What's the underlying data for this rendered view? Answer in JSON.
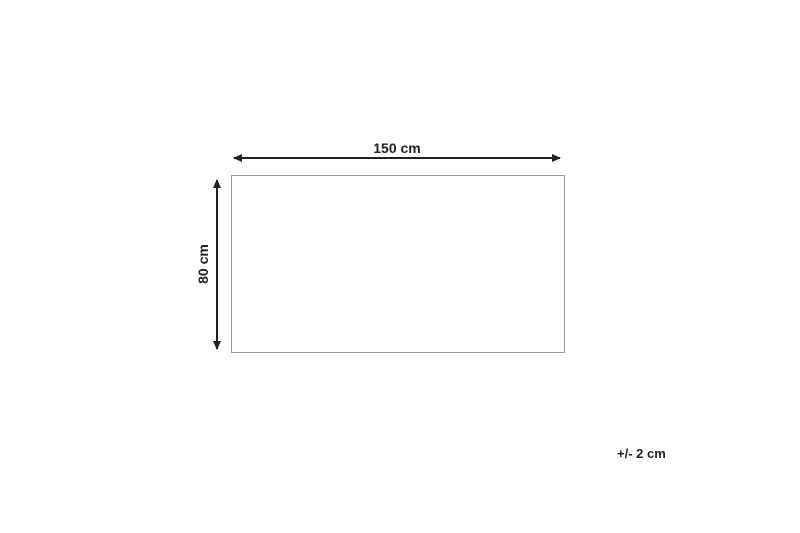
{
  "diagram": {
    "width_label": "150 cm",
    "height_label": "80 cm",
    "tolerance_label": "+/- 2 cm"
  },
  "colors": {
    "arrow": "#231f20",
    "outline_border": "#999999",
    "background": "#ffffff",
    "text": "#231f20"
  }
}
